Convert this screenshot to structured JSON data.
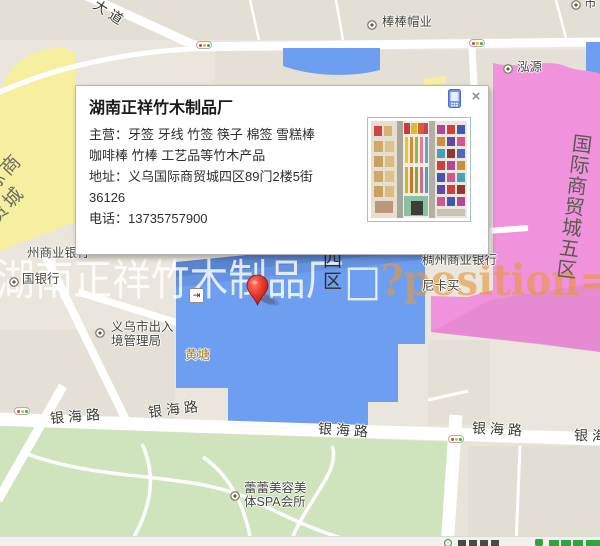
{
  "app": {
    "type": "map-infowindow-screenshot"
  },
  "popup": {
    "title": "湖南正祥竹木制品厂",
    "lines": [
      "主营：牙签 牙线 竹签 筷子 棉签 雪糕棒",
      "咖啡棒 竹棒 工艺品等竹木产品",
      "地址：义乌国际商贸城四区89门2楼5街",
      "36126",
      "电话：13735757900"
    ],
    "close": "×",
    "phone_icon": "mobile-phone-icon",
    "thumbnail": "storefront-product-photo"
  },
  "watermark": {
    "cn": "湖南正祥竹木制品厂□",
    "latin": "?position=9"
  },
  "map": {
    "area_labels": {
      "blue_district": "四区",
      "pink_district": "国际商贸城五区",
      "yellow_district": "国际商贸城"
    },
    "road_labels": [
      {
        "t": "大道",
        "x": 92,
        "y": 3,
        "r": 33
      },
      {
        "t": "银海路",
        "x": 50,
        "y": 406,
        "r": -5
      },
      {
        "t": "银海路",
        "x": 148,
        "y": 399,
        "r": -7
      },
      {
        "t": "银海路",
        "x": 318,
        "y": 420,
        "r": 4
      },
      {
        "t": "银海路",
        "x": 472,
        "y": 419,
        "r": 3
      },
      {
        "t": "银海路",
        "x": 574,
        "y": 426,
        "r": 2
      }
    ],
    "pois": [
      {
        "t": "棒棒帽业",
        "x": 382,
        "y": 15,
        "icon": true,
        "ix": 367,
        "iy": 20
      },
      {
        "t": "市",
        "x": 584,
        "y": -4,
        "icon": true,
        "ix": 571,
        "iy": 0
      },
      {
        "t": "泓源",
        "x": 517,
        "y": 60,
        "icon": true,
        "ix": 503,
        "iy": 64
      },
      {
        "t": "州商业银行",
        "x": 27,
        "y": 246
      },
      {
        "t": "国银行",
        "x": 22,
        "y": 272,
        "icon": true,
        "ix": 9,
        "iy": 277
      },
      {
        "t": "义乌市出入",
        "x": 111,
        "y": 320
      },
      {
        "t": "境管理局",
        "x": 111,
        "y": 334,
        "icon": true,
        "ix": 95,
        "iy": 328
      },
      {
        "t": "黄塘",
        "x": 185,
        "y": 348,
        "cls": "orange"
      },
      {
        "t": "稠州商业银行",
        "x": 422,
        "y": 253
      },
      {
        "t": "尼卡买",
        "x": 422,
        "y": 279
      },
      {
        "t": "蕾蕾美容美",
        "x": 244,
        "y": 481
      },
      {
        "t": "体SPA会所",
        "x": 244,
        "y": 495,
        "icon": true,
        "ix": 230,
        "iy": 491
      }
    ],
    "traffic_lights": [
      {
        "x": 196,
        "y": 41
      },
      {
        "x": 469,
        "y": 39
      },
      {
        "x": 14,
        "y": 407
      },
      {
        "x": 448,
        "y": 435
      }
    ],
    "entrance_icon": {
      "x": 189,
      "y": 288,
      "glyph": "⇥"
    }
  },
  "colors": {
    "map_bg": "#EAE6DD",
    "block": "#E3DFD4",
    "road": "#FFFFFF",
    "district_yellow": "#F6EF9F",
    "district_pink": "#F193DC",
    "district_blue": "#6E9EEF",
    "park_green": "#CFE3BC",
    "marker_red": "#E8392C",
    "phone_icon_blue": "#7293DD",
    "footer_green": "#2EA33E",
    "watermark_orange": "#E6963C"
  }
}
